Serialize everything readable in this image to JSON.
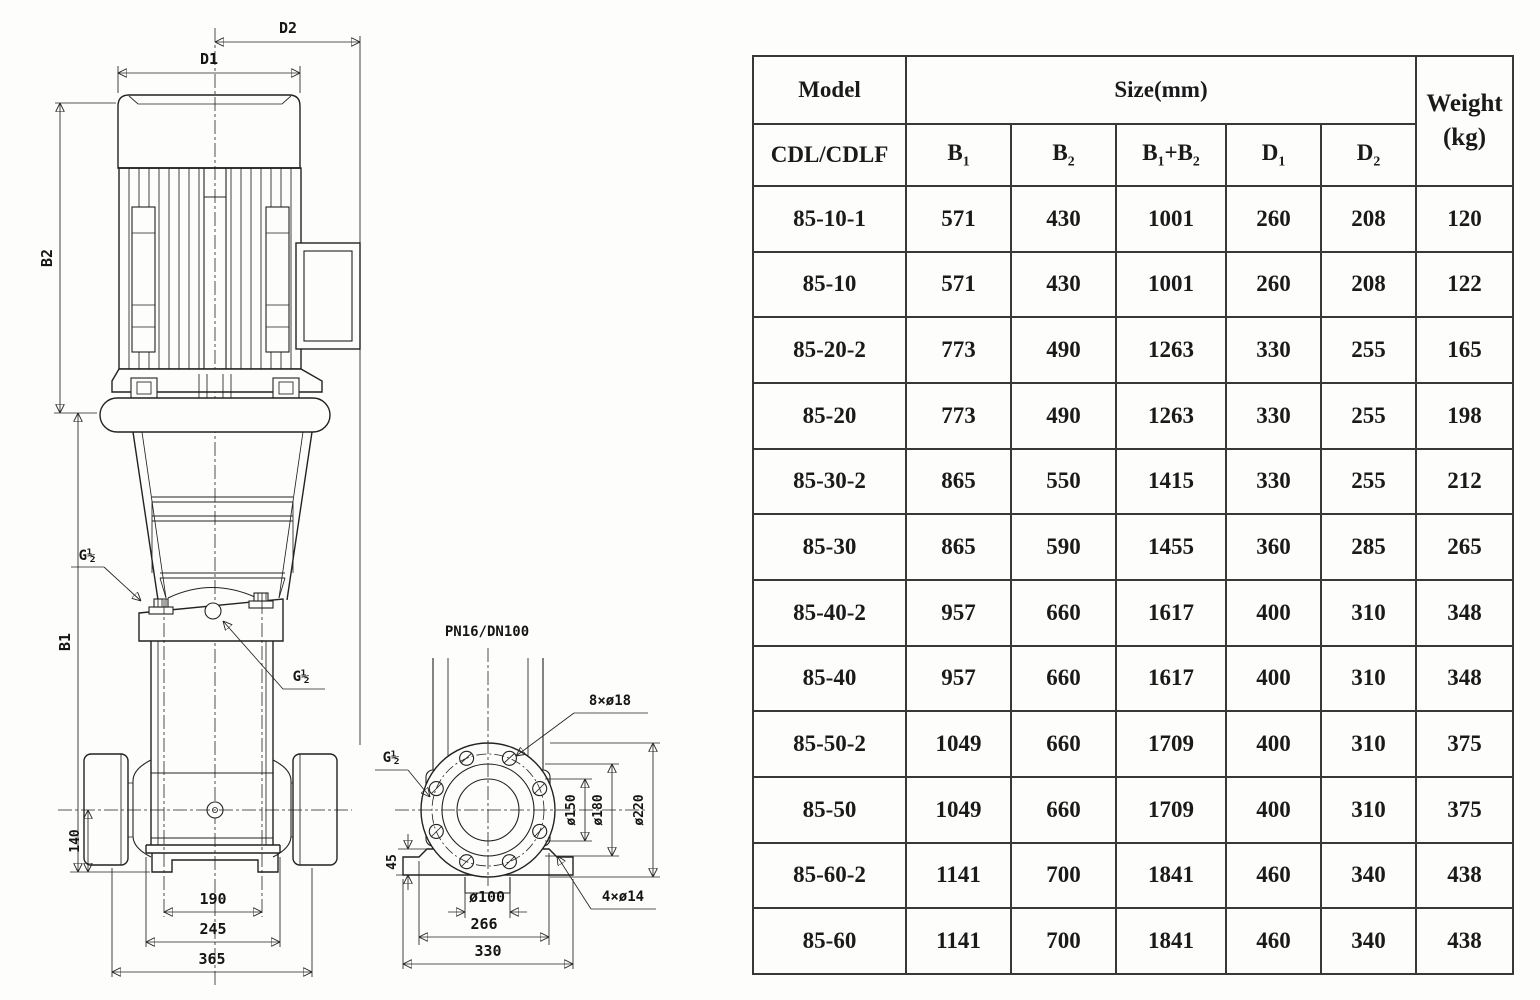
{
  "drawing": {
    "front": {
      "d1": "D1",
      "d2": "D2",
      "b1": "B1",
      "b2": "B2",
      "dim140": "140",
      "dim190": "190",
      "dim245": "245",
      "dim365": "365",
      "port_left": "G½",
      "port_right": "G½"
    },
    "flange": {
      "conn": "PN16/DN100",
      "boltholes": "8×ø18",
      "port": "G½",
      "dim45": "45",
      "d150": "ø150",
      "d180": "ø180",
      "d220": "ø220",
      "d100": "ø100",
      "dim266": "266",
      "dim330": "330",
      "baseholes": "4×ø14"
    }
  },
  "table": {
    "header": {
      "model": "Model",
      "size": "Size(mm)",
      "weight": "Weight",
      "weight_unit": "(kg)",
      "series": "CDL/CDLF",
      "b1": "B1",
      "b2": "B2",
      "b1b2": "B1+B2",
      "d1": "D1",
      "d2": "D2"
    },
    "rows": [
      {
        "model": "85-10-1",
        "b1": "571",
        "b2": "430",
        "b1b2": "1001",
        "d1": "260",
        "d2": "208",
        "weight": "120"
      },
      {
        "model": "85-10",
        "b1": "571",
        "b2": "430",
        "b1b2": "1001",
        "d1": "260",
        "d2": "208",
        "weight": "122"
      },
      {
        "model": "85-20-2",
        "b1": "773",
        "b2": "490",
        "b1b2": "1263",
        "d1": "330",
        "d2": "255",
        "weight": "165"
      },
      {
        "model": "85-20",
        "b1": "773",
        "b2": "490",
        "b1b2": "1263",
        "d1": "330",
        "d2": "255",
        "weight": "198"
      },
      {
        "model": "85-30-2",
        "b1": "865",
        "b2": "550",
        "b1b2": "1415",
        "d1": "330",
        "d2": "255",
        "weight": "212"
      },
      {
        "model": "85-30",
        "b1": "865",
        "b2": "590",
        "b1b2": "1455",
        "d1": "360",
        "d2": "285",
        "weight": "265"
      },
      {
        "model": "85-40-2",
        "b1": "957",
        "b2": "660",
        "b1b2": "1617",
        "d1": "400",
        "d2": "310",
        "weight": "348"
      },
      {
        "model": "85-40",
        "b1": "957",
        "b2": "660",
        "b1b2": "1617",
        "d1": "400",
        "d2": "310",
        "weight": "348"
      },
      {
        "model": "85-50-2",
        "b1": "1049",
        "b2": "660",
        "b1b2": "1709",
        "d1": "400",
        "d2": "310",
        "weight": "375"
      },
      {
        "model": "85-50",
        "b1": "1049",
        "b2": "660",
        "b1b2": "1709",
        "d1": "400",
        "d2": "310",
        "weight": "375"
      },
      {
        "model": "85-60-2",
        "b1": "1141",
        "b2": "700",
        "b1b2": "1841",
        "d1": "460",
        "d2": "340",
        "weight": "438"
      },
      {
        "model": "85-60",
        "b1": "1141",
        "b2": "700",
        "b1b2": "1841",
        "d1": "460",
        "d2": "340",
        "weight": "438"
      }
    ]
  }
}
